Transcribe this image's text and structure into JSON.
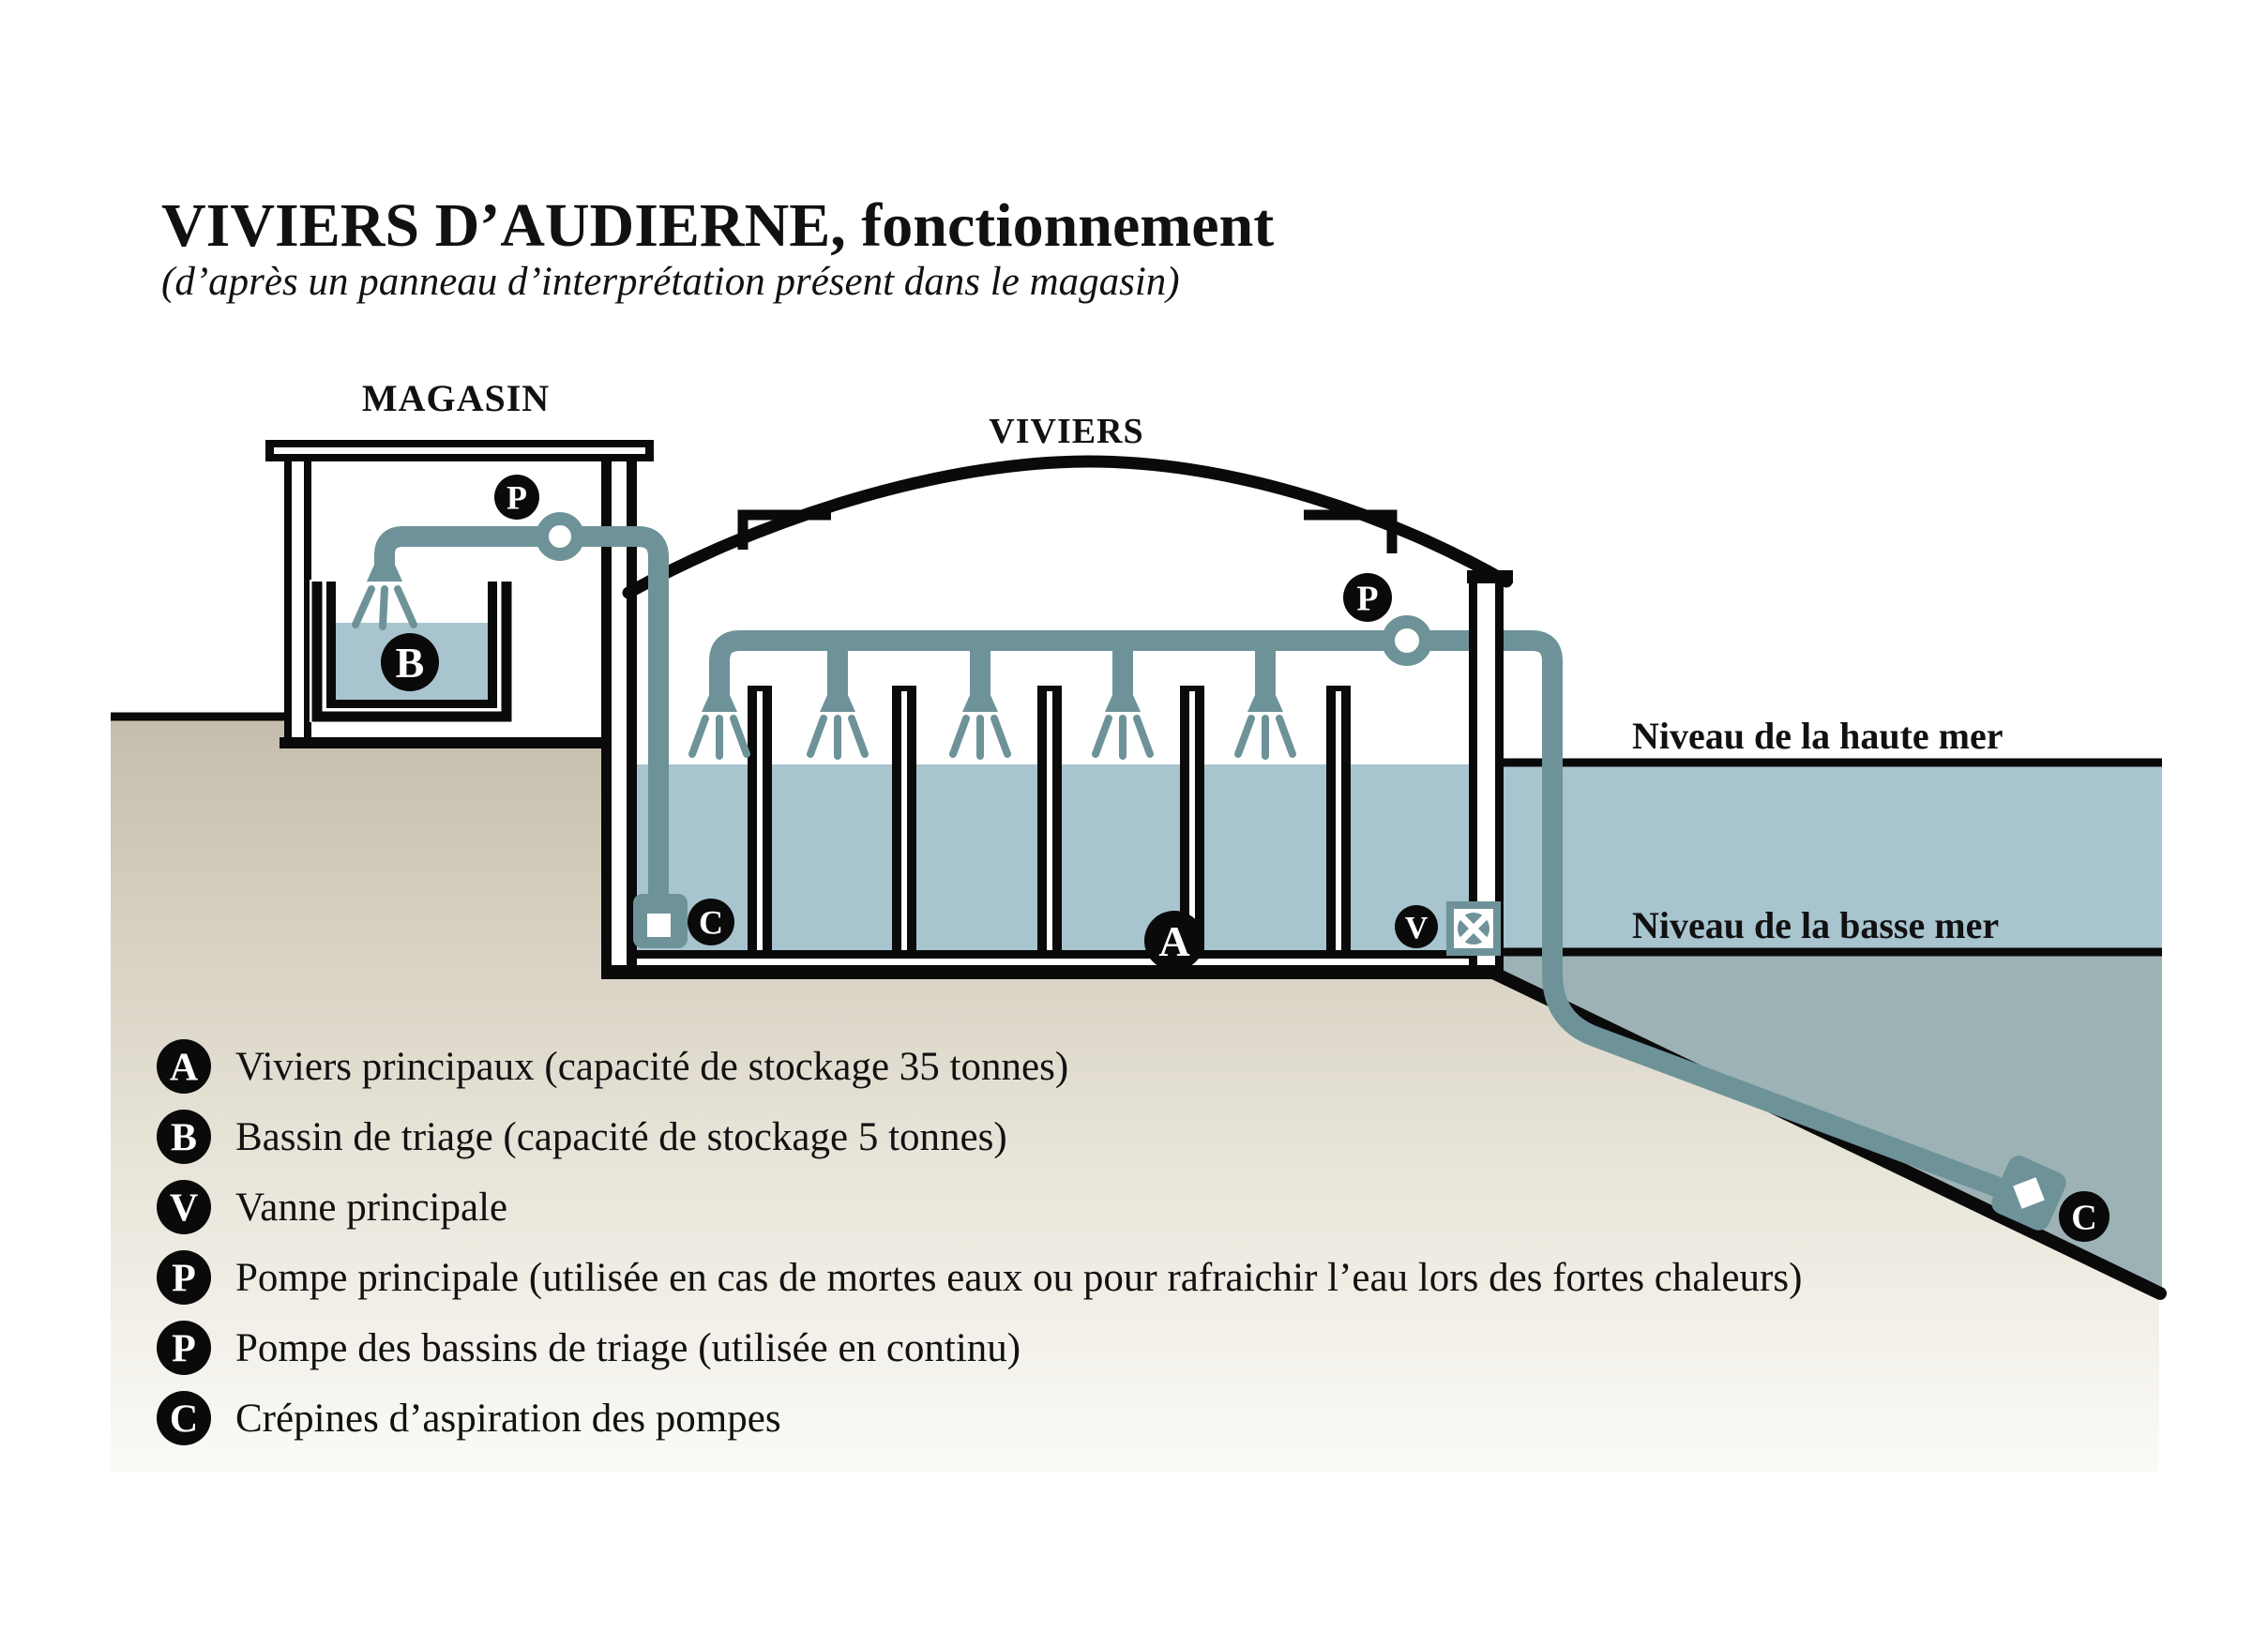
{
  "title": {
    "main": "VIVIERS D’AUDIERNE, fonctionnement",
    "subtitle": "(d’après un panneau d’interprétation présent dans le magasin)"
  },
  "diagram": {
    "magasin_label": "MAGASIN",
    "viviers_label": "VIVIERS",
    "high_tide_label": "Niveau de la haute mer",
    "low_tide_label": "Niveau de la basse mer",
    "badges": {
      "pump_triage": "P",
      "pump_main": "P",
      "basin": "B",
      "main_tanks": "A",
      "valve": "V",
      "strainer_left": "C",
      "strainer_right": "C"
    }
  },
  "legend": {
    "items": [
      {
        "letter": "A",
        "text": "Viviers principaux (capacité de stockage 35 tonnes)"
      },
      {
        "letter": "B",
        "text": "Bassin de triage (capacité de stockage 5 tonnes)"
      },
      {
        "letter": "V",
        "text": "Vanne principale"
      },
      {
        "letter": "P",
        "text": "Pompe principale (utilisée en cas de mortes eaux ou pour rafraichir l’eau lors des fortes chaleurs)"
      },
      {
        "letter": "P",
        "text": "Pompe des bassins de triage (utilisée en continu)"
      },
      {
        "letter": "C",
        "text": "Crépines d’aspiration des pompes"
      }
    ]
  },
  "colors": {
    "black": "#0a0a0a",
    "text": "#111111",
    "pipe": "#6d9399",
    "water": "#a8c4cf",
    "deep_water": "#9db2b5",
    "ground_top": "#c5bdab",
    "ground_mid": "#e6e2d6",
    "ground_bottom": "#fbfaf6"
  }
}
